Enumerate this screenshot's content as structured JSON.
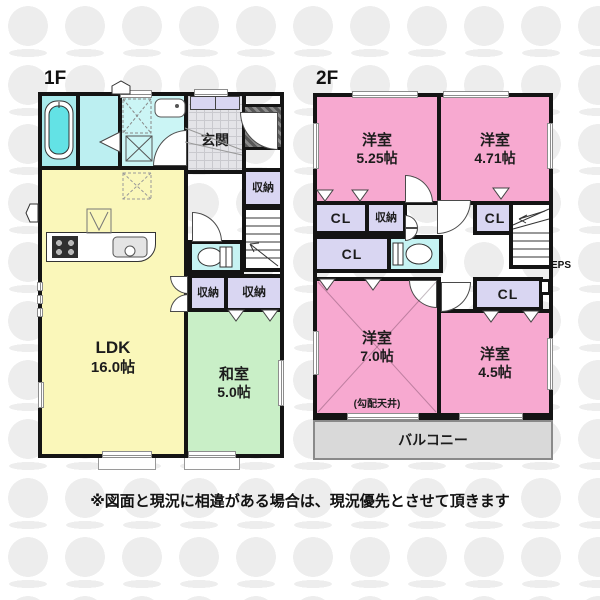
{
  "page": {
    "watermark_color": "#ededed"
  },
  "colors": {
    "wall": "#141414",
    "room_pink": "#f7a9d0",
    "ldk_yellow": "#faf7ba",
    "washitsu_green": "#c9efc7",
    "bath_cyan": "#a8eaec",
    "laundry_cyan": "#bceff1",
    "powder_cyan": "#cbf5f5",
    "toilet_cyan": "#c6f3f3",
    "tub_cyan": "#63e2e5",
    "closet_purple": "#d9d6f2",
    "genkan_gray": "#e4e4e8",
    "balcony_gray": "#d9d9d9"
  },
  "floor1": {
    "label": "1F",
    "ldk": {
      "name": "LDK",
      "size": "16.0帖"
    },
    "washitsu": {
      "name": "和室",
      "size": "5.0帖"
    },
    "genkan": "玄関",
    "closet": "収納"
  },
  "floor2": {
    "label": "2F",
    "room_525": {
      "name": "洋室",
      "size": "5.25帖"
    },
    "room_471": {
      "name": "洋室",
      "size": "4.71帖"
    },
    "room_70": {
      "name": "洋室",
      "size": "7.0帖",
      "note": "(勾配天井)"
    },
    "room_45": {
      "name": "洋室",
      "size": "4.5帖"
    },
    "cl": "CL",
    "closet": "収納",
    "eps": "EPS",
    "balcony": "バルコニー"
  },
  "footer": {
    "disclaimer": "※図面と現況に相違がある場合は、現況優先とさせて頂きます"
  }
}
